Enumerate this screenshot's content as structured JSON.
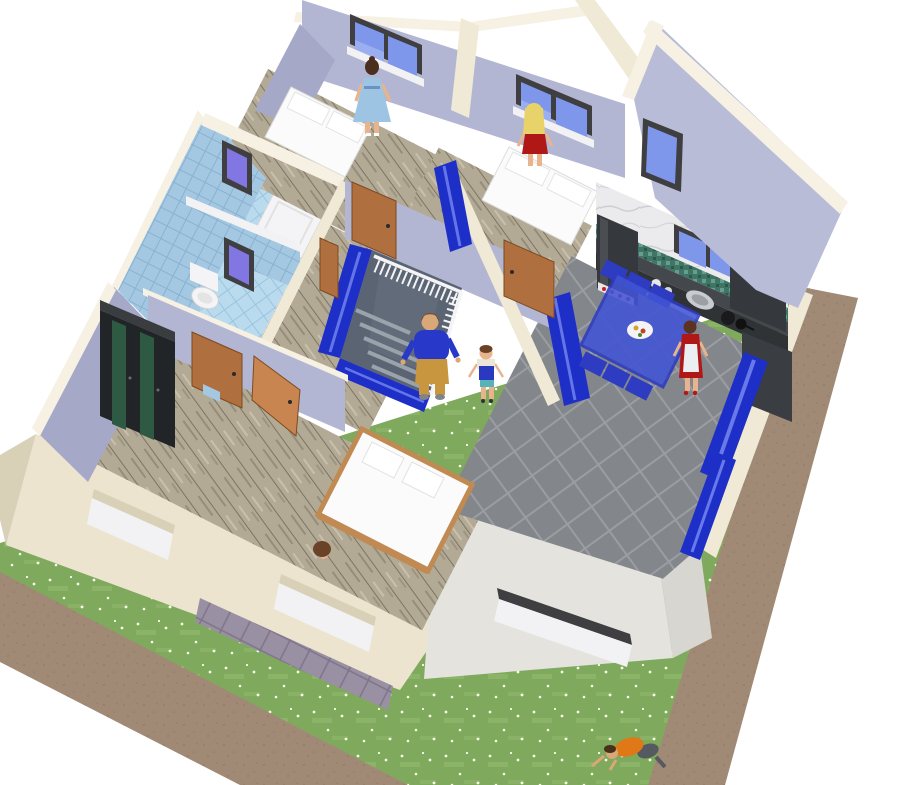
{
  "meta": {
    "view": "3d-home-render",
    "description": "Aerial cutaway 3D view of a two-storey house: upper floor rooms (bathroom with blue tiles, three bedrooms, landing with staircase, kitchen-dining with gray tile floor) surrounded by a lawn with daisies and bare-soil borders"
  },
  "colors": {
    "background": "#ffffff",
    "grass": "#7fa95c",
    "grass_light": "#97bd74",
    "flower": "#f8fbe8",
    "dirt": "#a18a75",
    "dirt_dark": "#8f7a66",
    "wall_cream": "#efe9d6",
    "wall_cream_bright": "#f6f1e3",
    "wall_cream_shadow": "#d9d0b8",
    "wall_lavender": "#b3b6d3",
    "wall_lavender_dark": "#a5a8c6",
    "wall_lavender_ext": "#b8bcd6",
    "lower_wall_cream": "#ece4cf",
    "lower_wall_gray": "#e4e3de",
    "lower_wall_gray_dark": "#d7d6d1",
    "patio_tile": "#9a90a3",
    "patio_grout": "#7f7589",
    "wood_floor": "#b3aa96",
    "wood_streak_dark": "#7c7462",
    "wood_streak_light": "#cdc5b1",
    "tile_wall_blue": "#a4c8e2",
    "tile_wall_grid": "#88b2d1",
    "tile_floor_blue": "#badbee",
    "tile_floor_grid": "#9cc4de",
    "window_frame": "#3f3f41",
    "window_glass": "#7e97ea",
    "window_glass_light": "#a8b8f2",
    "window_glass_purple": "#8276e2",
    "window_sill": "#f2f2f4",
    "door_wood": "#b06f3e",
    "door_wood_light": "#c8854f",
    "door_handle": "#2a2a2a",
    "kitchen_floor": "#83868a",
    "kitchen_grout": "#9a9da1",
    "cabinet_dark": "#35383c",
    "cabinet_mid": "#44474b",
    "counter_front": "#303336",
    "marble_base": "#ebebee",
    "marble_vein": "#c6c6cc",
    "mosaic_green": "#3f7565",
    "mosaic_green_light": "#6fa89a",
    "mosaic_green_dark": "#2e574b",
    "dining_blue": "#4254d6",
    "dining_blue_dark": "#2d3cc0",
    "glass_door_blue": "#1e2fc8",
    "glass_door_streak": "#7687f0",
    "stair_pit": "#5b6472",
    "stair_tread": "#9aa2ac",
    "railing_white": "#f4f4f6",
    "bed_white": "#fbfbfb",
    "bed_frame_wood": "#c08a52",
    "fixture_white": "#f4f4f6",
    "skin": "#e8b48e",
    "skin_tan": "#d8a878",
    "appliance_red": "#c82020",
    "p1_hair": "#4a2e1e",
    "p1_dress": "#9ec4e4",
    "p2_hair": "#e8d26a",
    "p2_dress": "#b01818",
    "p3_hair": "#7a4a2a",
    "p3_shirt": "#2838c8",
    "p3_pants": "#c8963f",
    "p4_hair": "#6a4228",
    "p4_shirt": "#ece6d6",
    "p4_overall": "#2a3ac0",
    "p4_shorts": "#56b4b8",
    "p5_hair": "#5a3420",
    "p5_dress": "#b01818",
    "p5_apron": "#eceff1",
    "p6_hair": "#6a4228",
    "p7_hair": "#4a3018",
    "p7_shirt": "#e07818",
    "p7_pants": "#555a60"
  },
  "scene": {
    "rooms": [
      {
        "id": "bathroom",
        "floor": "blue-tiles",
        "walls": "blue-tiles",
        "fixtures": [
          "shower-tray",
          "toilet"
        ],
        "windows": 2
      },
      {
        "id": "bedroom-1",
        "floor": "wood",
        "walls": "lavender",
        "furniture": [
          "white-double-bed"
        ],
        "windows": 1,
        "occupant": "woman-blue-dress"
      },
      {
        "id": "bedroom-2",
        "floor": "wood",
        "walls": "lavender",
        "furniture": [
          "white-double-bed"
        ],
        "windows": 1,
        "occupant": "woman-red-dress"
      },
      {
        "id": "landing",
        "floor": "wood",
        "features": [
          "staircase-opening",
          "white-railing",
          "blue-glass-panels"
        ],
        "occupants": [
          "man-blue-sweater",
          "child-overalls"
        ]
      },
      {
        "id": "bedroom-3",
        "floor": "wood",
        "walls": "lavender",
        "furniture": [
          "green-wardrobe",
          "wood-frame-double-bed"
        ],
        "doors": 2
      },
      {
        "id": "kitchen-dining",
        "floor": "gray-tiles",
        "walls": "marble-and-lavender",
        "furniture": [
          "fridge",
          "counter-with-sink-and-hob",
          "tall-cabinets",
          "blue-dining-table",
          "blue-chairs"
        ],
        "windows": 3,
        "glass_doors": 2,
        "occupant": "woman-apron"
      }
    ],
    "garden": {
      "lawn": "grass-with-daisies",
      "borders": "bare-soil",
      "patio": "purple-tiles",
      "occupant": "child-orange-shirt"
    },
    "people": [
      {
        "id": "woman-blue-dress",
        "location": "bedroom-1"
      },
      {
        "id": "woman-red-dress",
        "location": "bedroom-2"
      },
      {
        "id": "man-blue-sweater",
        "location": "staircase"
      },
      {
        "id": "child-overalls",
        "location": "landing"
      },
      {
        "id": "woman-apron",
        "location": "kitchen"
      },
      {
        "id": "child-by-bed",
        "location": "bedroom-3"
      },
      {
        "id": "child-orange-shirt",
        "location": "garden"
      }
    ]
  }
}
